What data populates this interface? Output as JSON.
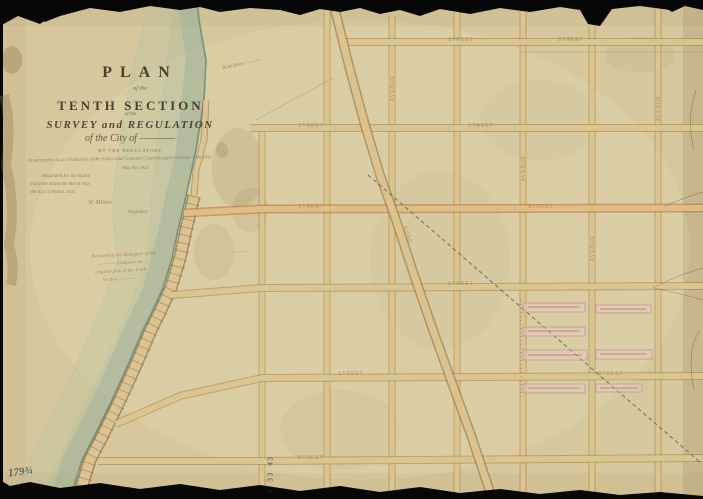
{
  "map": {
    "title": {
      "plan": "PLAN",
      "of_the": "of the",
      "section": "TENTH SECTION",
      "of_the2": "of the",
      "survey": "SURVEY and REGULATION",
      "city_script": "of the City of ————",
      "subline": "BY THE REGULATORS"
    },
    "notes": {
      "n1": "In pursuance of an Ordinance of the Select and Common Councils approved Sept 30th 1831",
      "n2": "Aug 4th 1831",
      "n3": "Regulated for the Board",
      "n4": "and plan dated the 9th of Sept",
      "n5": "9th day of March 1831",
      "n6": "W. Milnor",
      "n7": "Regulator"
    },
    "red_note": {
      "r1": "Received of the Managers of the",
      "r2": "———— Company the",
      "r3": "original plan of the Tenth",
      "r4": "Section ————"
    },
    "annotations": {
      "ferry_note": "Road from ————",
      "mid_note": "—————",
      "archive_number": "179¾",
      "stamp": "C 33 43"
    },
    "street_labels": [
      {
        "text": "STREET"
      },
      {
        "text": "STREET"
      },
      {
        "text": "STREET"
      },
      {
        "text": "STREET"
      },
      {
        "text": "STREET"
      },
      {
        "text": "STREET"
      },
      {
        "text": "STREET"
      },
      {
        "text": "STREET"
      },
      {
        "text": "STREET"
      },
      {
        "text": "STREET"
      },
      {
        "text": "AVENUE"
      },
      {
        "text": "AVENUE"
      },
      {
        "text": "AVENUE"
      },
      {
        "text": "AVENUE"
      },
      {
        "text": "ROAD"
      }
    ],
    "colors": {
      "paper": "#d8c99e",
      "street_fill": "#dcc48f",
      "street_edge": "#9a7a4a",
      "major_street_edge": "#bf6a3c",
      "river": "#8fac9a",
      "lot_pink": "#cf8fa5",
      "lot_red": "#c05050",
      "ink": "#33291c"
    }
  }
}
